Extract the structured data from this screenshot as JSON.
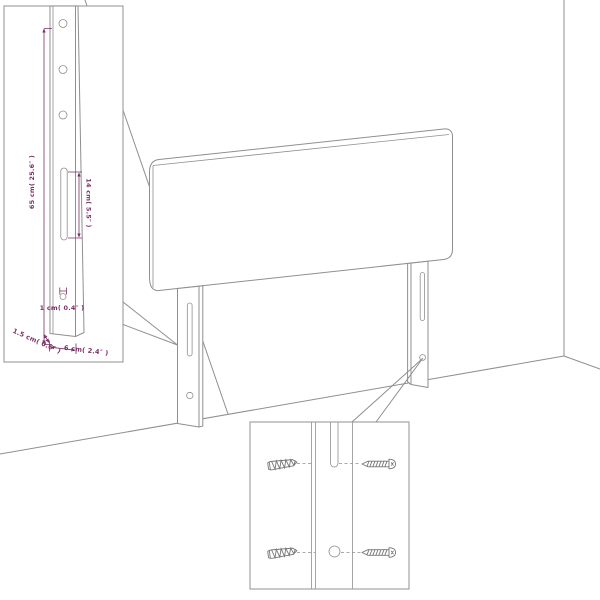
{
  "colors": {
    "background": "#ffffff",
    "outline_gray": "#8f8f8f",
    "dimension_purple": "#7a3166",
    "inset_border_gray": "#a3a3a3",
    "screw_gray": "#777777"
  },
  "leg_inset": {
    "dims": {
      "height": "65 cm( 25.6″ )",
      "slot": "14 cm( 5.5″ )",
      "hole": "1 cm( 0.4″ )",
      "thickness": "1.5 cm( 0.6″ )",
      "width": "6 cm( 2.4″ )"
    }
  },
  "screw_inset": {
    "icons": [
      "anchor-screw-icon",
      "wood-screw-icon"
    ]
  }
}
